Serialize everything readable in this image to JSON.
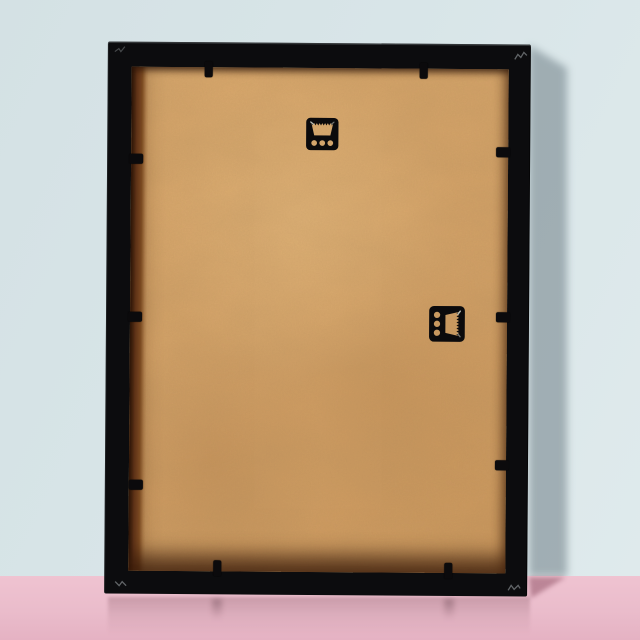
{
  "scene": {
    "description": "Back view of a black portrait picture frame with a kraft MDF backing board, standing on a glossy pink surface against a pale blue wall, soft shadow cast to the right",
    "colors": {
      "wall": "#d8e5e8",
      "floor": "#eabccb",
      "frame_black": "#0c0c0e",
      "board_tan": "#d2a167",
      "rabbet_brown": "#6e3d1f",
      "hardware_black": "#0b0a0c",
      "wall_shadow": "#5f6e78",
      "floor_shadow": "#925468",
      "corner_mark": "#9aa0a3"
    },
    "objects": {
      "frame": {
        "type": "picture-frame-back",
        "orientation": "portrait",
        "material": "black wood"
      },
      "backing": {
        "type": "mdf-board",
        "finish": "kraft tan"
      },
      "top_hanger": {
        "type": "sawtooth-hanger",
        "holes": 3,
        "rotation_deg": 0
      },
      "side_hanger": {
        "type": "sawtooth-hanger",
        "holes": 3,
        "rotation_deg": 90
      },
      "flex_tabs": {
        "top": 2,
        "left": 3,
        "right": 3,
        "bottom": 2
      }
    }
  }
}
